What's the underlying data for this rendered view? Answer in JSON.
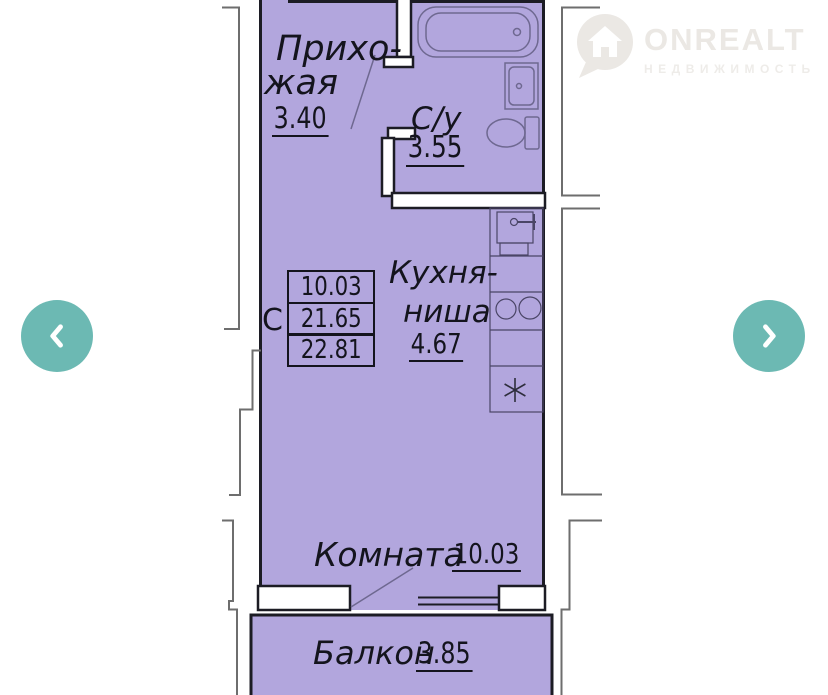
{
  "watermark": {
    "brand": "ONREALT",
    "subtitle": "НЕДВИЖИМОСТЬ"
  },
  "plan": {
    "rooms": {
      "hallway": {
        "name_line1": "Прихо-",
        "name_line2": "жая",
        "area": "3.40"
      },
      "bathroom": {
        "name": "С/у",
        "area": "3.55"
      },
      "kitchen": {
        "name_line1": "Кухня-",
        "name_line2": "ниша",
        "area": "4.67"
      },
      "room": {
        "name": "Комната",
        "area": "10.03"
      },
      "balcony": {
        "name": "Балкон",
        "area": "3.85"
      }
    },
    "area_table": {
      "label": "С",
      "rows": [
        "10.03",
        "21.65",
        "22.81"
      ]
    }
  },
  "colors": {
    "room_fill": "#b2a6dd",
    "wall": "#1c1c24",
    "fixture": "#6e6890",
    "counter_line": "#4a4566",
    "snowflake": "#2e2e3c",
    "neighbor_outline": "#6e6e6e",
    "nav_button": "#6cb9b3",
    "nav_chevron": "#ffffff",
    "wm": "#ebe8e4"
  }
}
